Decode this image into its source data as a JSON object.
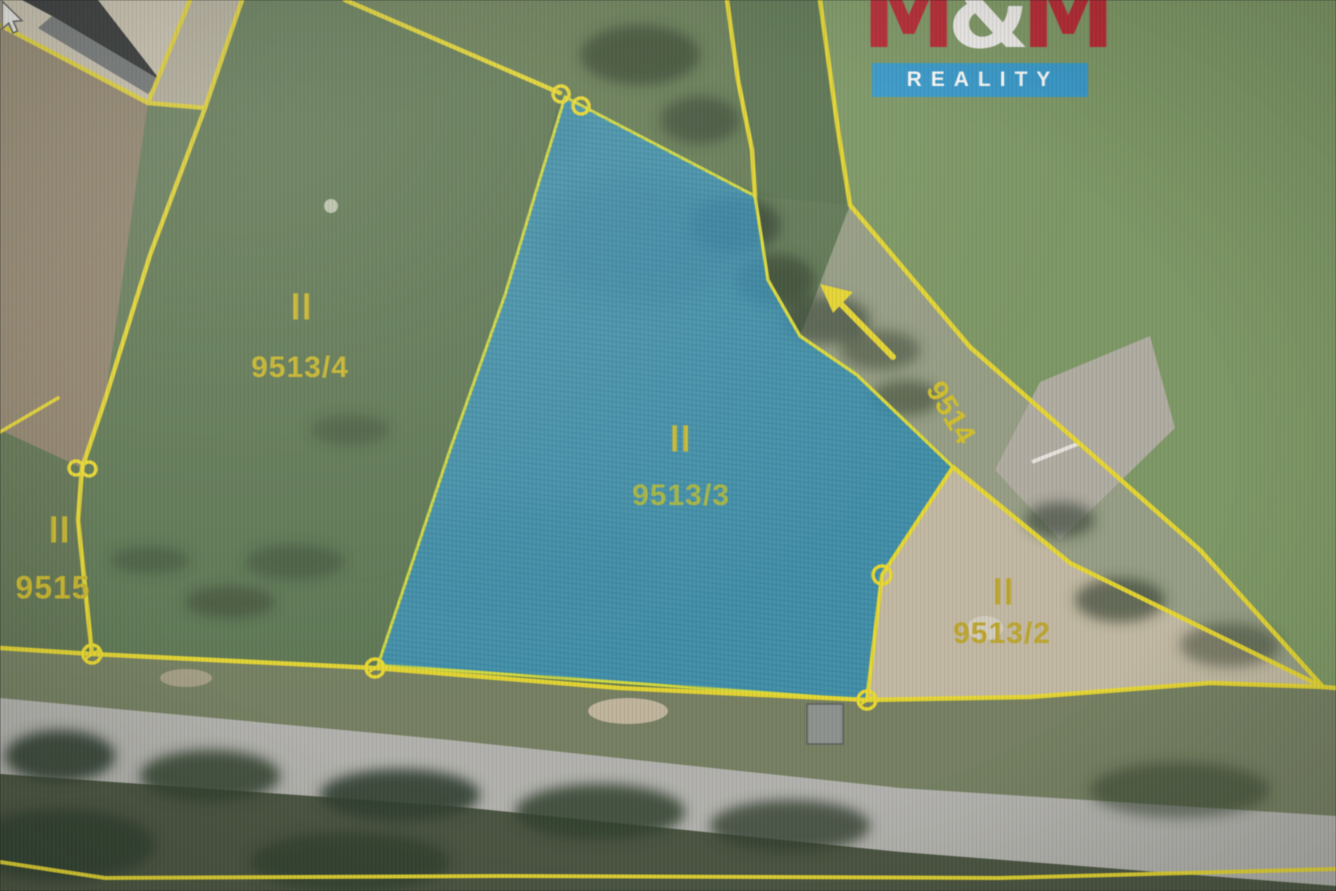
{
  "window": {
    "width": 1336,
    "height": 891,
    "kind": "cadastral aerial map photo"
  },
  "logo": {
    "m1": "M",
    "amp": "&",
    "m2": "M",
    "tagline": "REALITY",
    "brand_red": "#c42430",
    "tagline_blue": "#2f9cd3"
  },
  "map": {
    "boundary_color": "#f0dd1f",
    "highlight_parcel": "9513/3",
    "highlight_fill": "#2f9fd8",
    "label_color": "#cdb81d"
  },
  "parcels": {
    "p9513_4": {
      "marker": "II",
      "number": "9513/4"
    },
    "p9513_3": {
      "marker": "II",
      "number": "9513/3"
    },
    "p9515": {
      "marker": "II",
      "number": "9515"
    },
    "p9513_2": {
      "marker": "II",
      "number": "9513/2"
    },
    "p9514": {
      "number": "9514"
    }
  },
  "cursor": {
    "shape": "arrow-pointer"
  }
}
